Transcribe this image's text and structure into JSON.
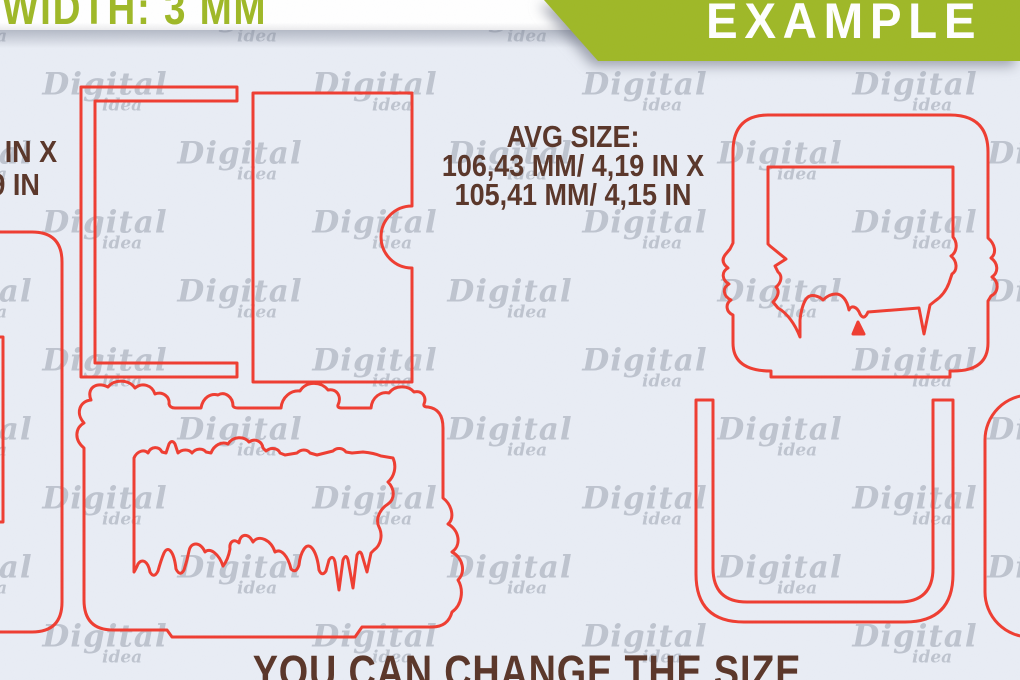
{
  "colors": {
    "background": "#e9edf5",
    "accent_green": "#9fb827",
    "outline_red": "#ef3d31",
    "text_brown": "#5a3629",
    "watermark_gray": "#b7bdc9",
    "band_white": "#ffffff"
  },
  "top_bar": {
    "width_label": "WIDTH: 3 MM",
    "example_banner": "EXAMPLE"
  },
  "annotations": {
    "avg_size_title": "AVG SIZE:",
    "avg_size_line2": "106,43 MM/ 4,19 IN X",
    "avg_size_line3": "105,41 MM/ 4,15 IN",
    "left_size_line1": "7 IN X",
    "left_size_line2": "9 IN",
    "footer_note": "YOU CAN CHANGE THE SIZE"
  },
  "watermark": {
    "word": "Digital",
    "subword": "idea"
  },
  "shapes": [
    "pocket-card-back-outline",
    "pocket-card-front-notch-outline",
    "partial-frame-left-outline",
    "cloud-grass-frame-outline",
    "profile-silhouette-frame-outline",
    "stand-u-channel-outline",
    "rounded-panel-right-outline"
  ]
}
